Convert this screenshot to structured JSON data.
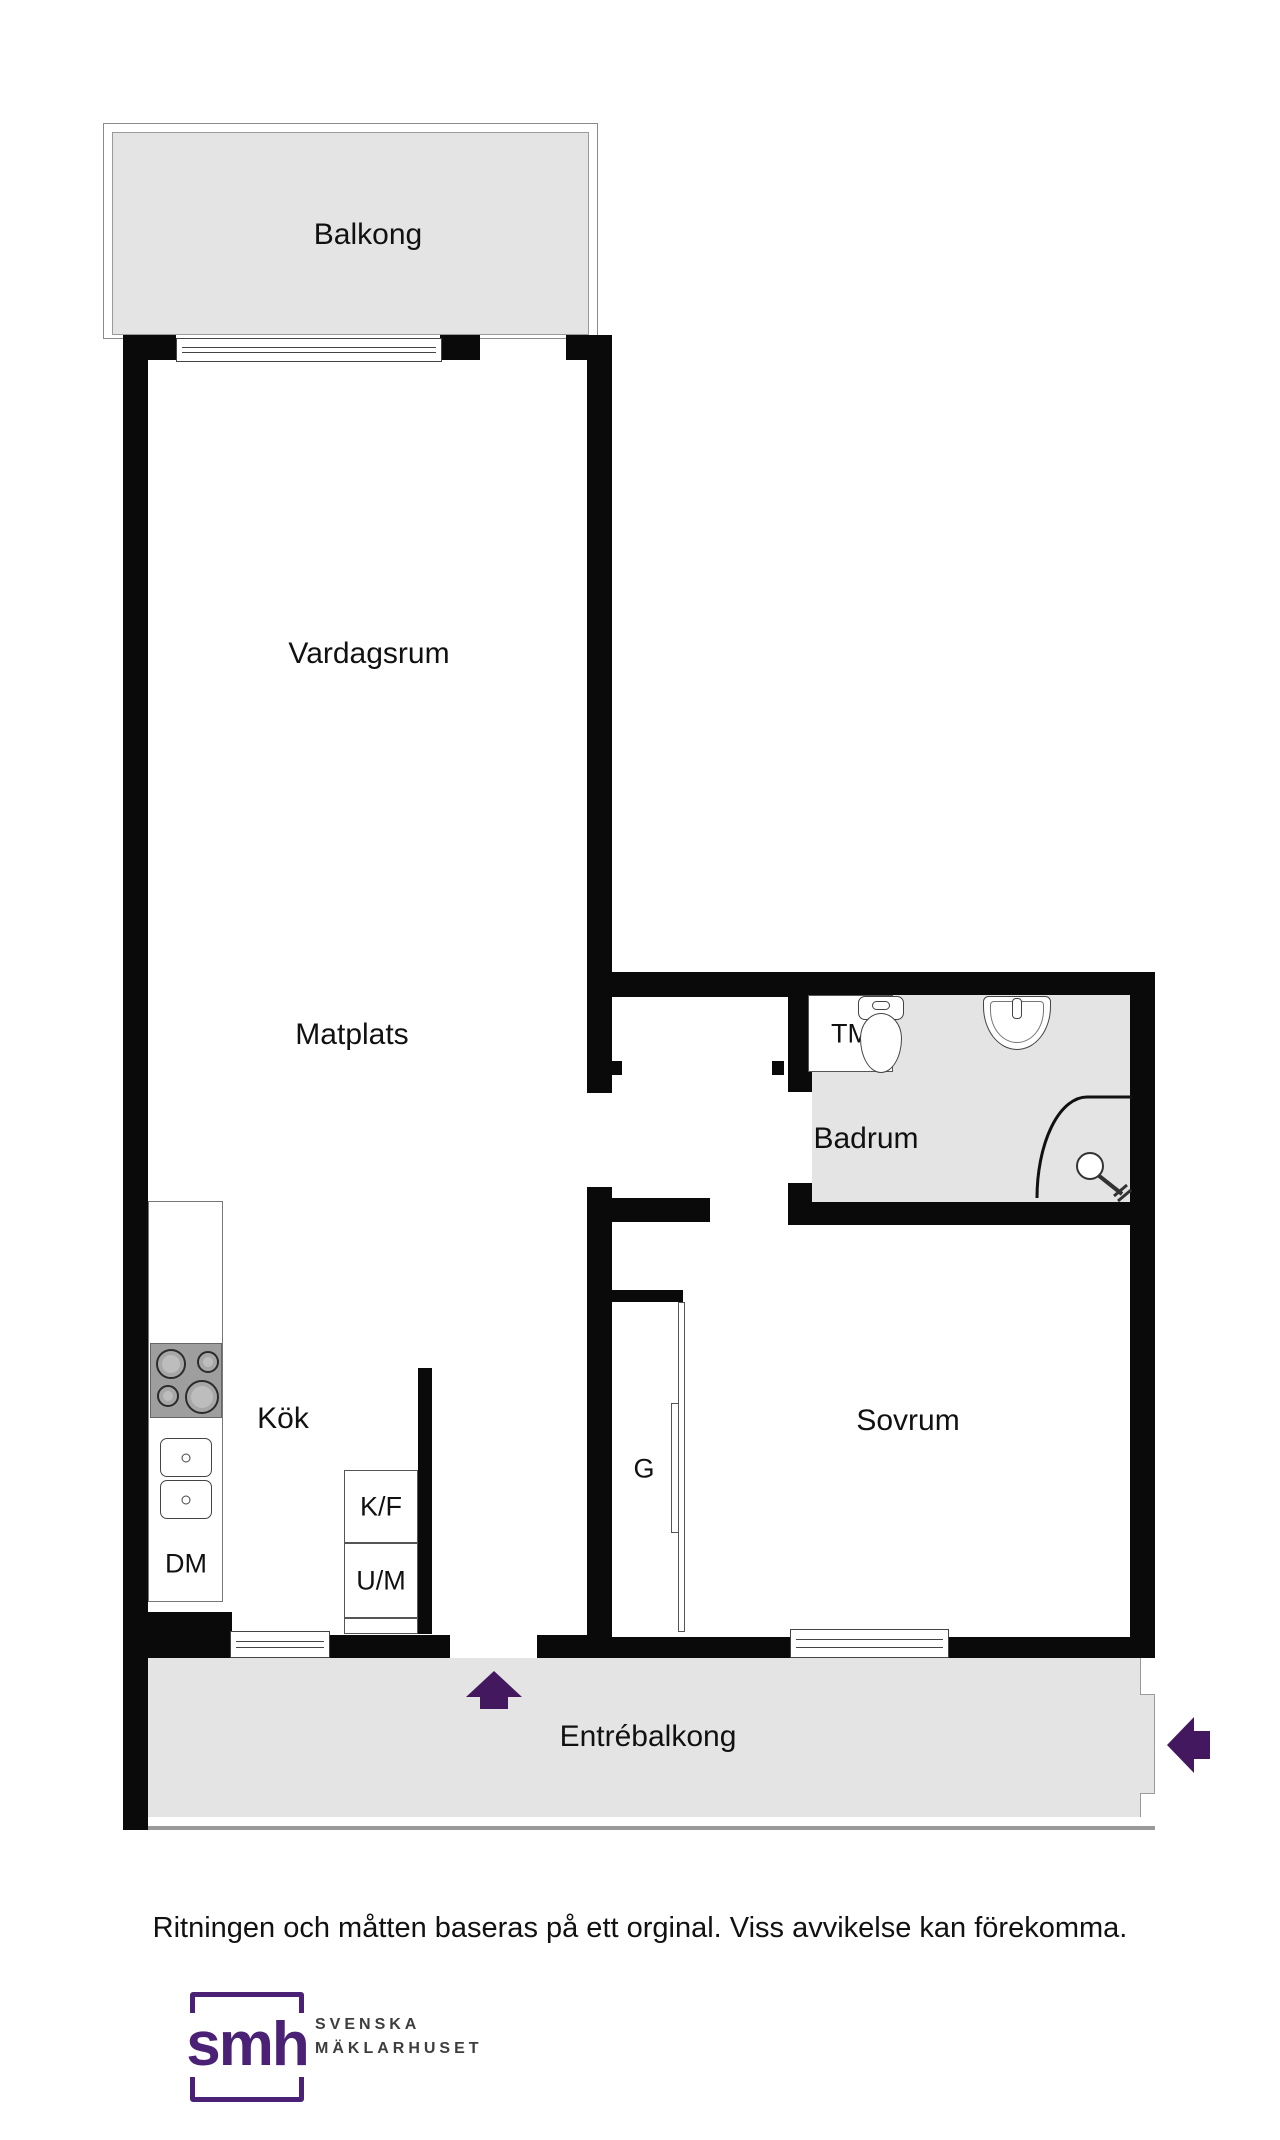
{
  "title": "Apartment floor plan",
  "rooms": {
    "balkong": "Balkong",
    "vardagsrum": "Vardagsrum",
    "matplats": "Matplats",
    "badrum": "Badrum",
    "sovrum": "Sovrum",
    "kok": "Kök",
    "entrebalkong": "Entrébalkong"
  },
  "fixtures": {
    "tm": "TM",
    "dm": "DM",
    "kf": "K/F",
    "um": "U/M",
    "g": "G"
  },
  "icons": {
    "entrance_arrow": "up-arrow-entrance",
    "side_arrow": "left-arrow-entrance",
    "toilet": "toilet-icon",
    "sink": "sink-icon",
    "shower": "shower-corner-icon",
    "stove": "stove-burners-icon"
  },
  "footer": {
    "disclaimer": "Ritningen och måtten baseras på ett orginal. Viss avvikelse kan förekomma."
  },
  "logo": {
    "monogram": "smh",
    "line1": "SVENSKA",
    "line2": "MÄKLARHUSET"
  },
  "colors": {
    "accent_purple": "#4b2175",
    "arrow_purple": "#44185e",
    "wall_black": "#0a0a0a",
    "floor_gray": "#e4e4e4",
    "fixture_border_gray": "#555555",
    "text_black": "#111111"
  }
}
